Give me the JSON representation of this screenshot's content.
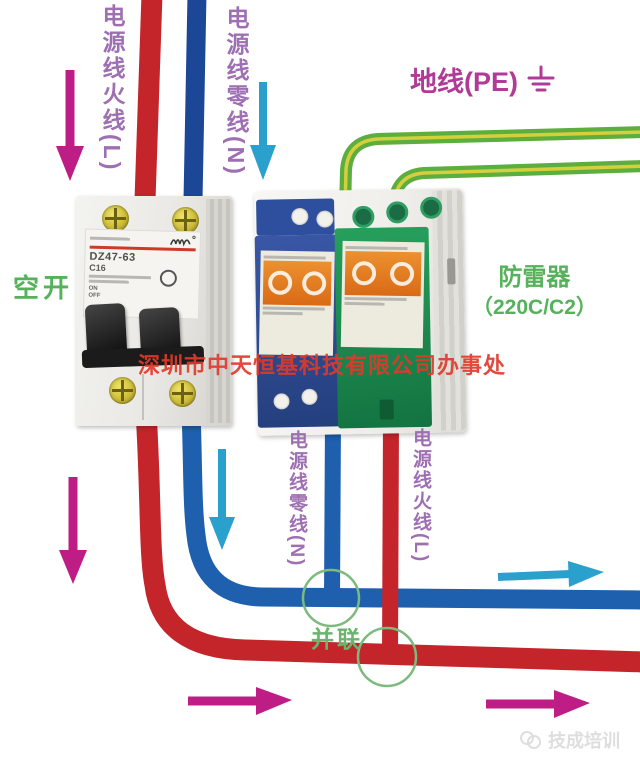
{
  "labels": {
    "live_in": "电源线火线(L)",
    "neutral_in": "电源线零线(N)",
    "ground": "地线(PE)",
    "breaker_name": "空开",
    "spd_name_line1": "防雷器",
    "spd_name_line2": "（220C/C2）",
    "neutral_out": "电源线零线(N)",
    "live_out": "电源线火线(L)",
    "parallel": "并联"
  },
  "breaker": {
    "model": "DZ47-63",
    "rating": "C16",
    "on_label": "ON",
    "off_label": "OFF"
  },
  "watermarks": {
    "company": "深圳市中天恒基科技有限公司办事处",
    "brand": "技成培训"
  },
  "colors": {
    "live": "#c3252b",
    "neutral_supply": "#1b4796",
    "neutral": "#1e5fae",
    "ground_green": "#5cae3f",
    "ground_stripe": "#d6cf3d",
    "arrow_magenta": "#bf1d86",
    "arrow_cyan": "#2aa0cd",
    "junction_green": "#7cba7e",
    "label_purple": "#9e6fb2",
    "label_green": "#55b25b",
    "ground_label_color": "#b03b96",
    "watermark_red": "#e0392b"
  }
}
